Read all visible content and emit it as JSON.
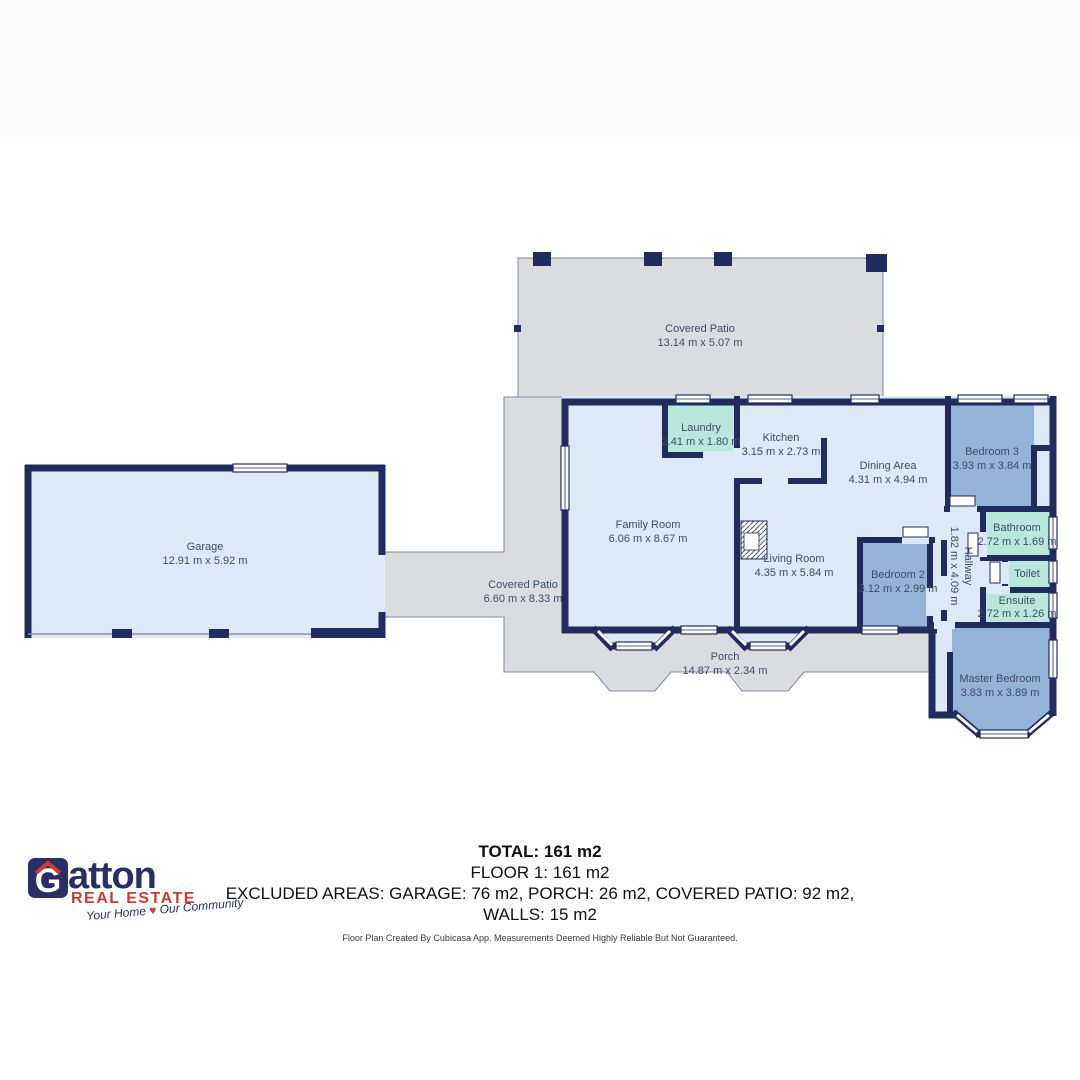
{
  "canvas": {
    "width": 1080,
    "height": 1080,
    "background": "#ffffff",
    "top_band_color": "#fcfcfd"
  },
  "colors": {
    "wall_navy": "#212b5e",
    "room_light_blue": "#dde9f7",
    "room_medium_blue": "#93b3d8",
    "room_teal": "#b7e8db",
    "patio_grey": "#dbdcdf",
    "patio_outline": "#7e88a5",
    "window_fill": "#ffffff",
    "label_text": "#3d4d68",
    "brand_navy": "#282f66",
    "brand_red": "#cf3a2f"
  },
  "rooms": {
    "covered_patio_top": {
      "name": "Covered Patio",
      "dims": "13.14 m x 5.07 m"
    },
    "garage": {
      "name": "Garage",
      "dims": "12.91 m x 5.92 m"
    },
    "covered_patio_left": {
      "name": "Covered Patio",
      "dims": "6.60 m x 8.33 m"
    },
    "family_room": {
      "name": "Family Room",
      "dims": "6.06 m x 8.67 m"
    },
    "laundry": {
      "name": "Laundry",
      "dims": "2.41 m x 1.80 m"
    },
    "kitchen": {
      "name": "Kitchen",
      "dims": "3.15 m x 2.73 m"
    },
    "dining_area": {
      "name": "Dining Area",
      "dims": "4.31 m x 4.94 m"
    },
    "living_room": {
      "name": "Living Room",
      "dims": "4.35 m x 5.84 m"
    },
    "bedroom_2": {
      "name": "Bedroom 2",
      "dims": "3.12 m x 2.99 m"
    },
    "bedroom_3": {
      "name": "Bedroom 3",
      "dims": "3.93 m x 3.84 m"
    },
    "bathroom": {
      "name": "Bathroom",
      "dims": "2.72 m x 1.69 m"
    },
    "toilet": {
      "name": "Toilet",
      "dims": ""
    },
    "ensuite": {
      "name": "Ensuite",
      "dims": "2.72 m x 1.26 m"
    },
    "hallway": {
      "name": "Hallway",
      "dims": "1.82 m x 4.09 m"
    },
    "master_bedroom": {
      "name": "Master Bedroom",
      "dims": "3.83 m x 3.89 m"
    },
    "porch": {
      "name": "Porch",
      "dims": "14.87 m x 2.34 m"
    }
  },
  "summary": {
    "total": "TOTAL: 161 m2",
    "floor": "FLOOR 1: 161 m2",
    "excluded": "EXCLUDED AREAS: GARAGE: 76 m2, PORCH: 26 m2, COVERED PATIO: 92 m2,",
    "walls": "WALLS: 15 m2",
    "disclaimer": "Floor Plan Created By Cubicasa App. Measurements Deemed Highly Reliable But Not Guaranteed."
  },
  "branding": {
    "logo_g": "G",
    "logo_rest": "atton",
    "logo_line2": "REAL ESTATE",
    "tagline_left": "Your Home",
    "tagline_heart": "♥",
    "tagline_right": "Our Community"
  }
}
